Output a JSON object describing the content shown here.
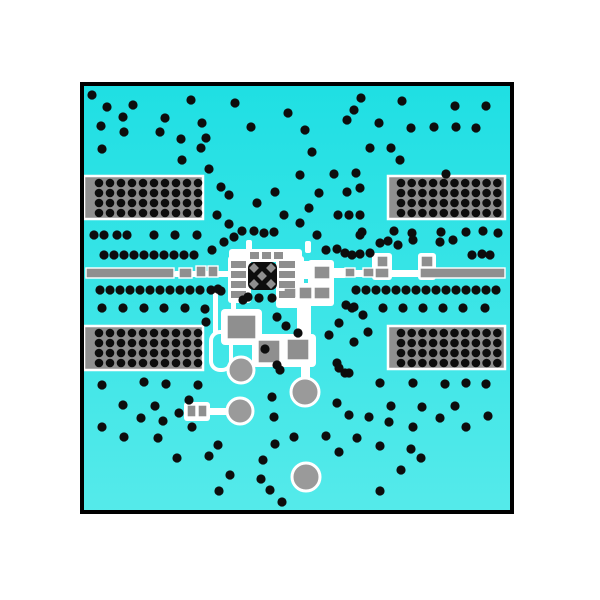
{
  "scene": {
    "width": 600,
    "height": 600,
    "background": "#ffffff",
    "description": "pcb-layer-view"
  },
  "board": {
    "x": 82,
    "y": 84,
    "w": 430,
    "h": 428,
    "border_color": "#000000",
    "border_width": 4,
    "fill_top": "#1fdfe3",
    "fill_bottom": "#55eaea"
  },
  "colors": {
    "pad_gray": "#8f8f8f",
    "circle_gray": "#9a9a9a",
    "via_black": "#0d0d0d",
    "mask_white": "#ffffff"
  },
  "via_radius": 4.6,
  "connector_blocks": [
    {
      "x": 84,
      "y": 176,
      "w": 119,
      "h": 43,
      "rows": 4,
      "cols": 10,
      "dot_x0": 99,
      "dot_y0": 183,
      "dx": 11,
      "dy": 10,
      "dot_r": 4.3
    },
    {
      "x": 388,
      "y": 176,
      "w": 117,
      "h": 43,
      "rows": 4,
      "cols": 10,
      "dot_x0": 401,
      "dot_y0": 183,
      "dx": 10.7,
      "dy": 10,
      "dot_r": 4.3
    },
    {
      "x": 84,
      "y": 326,
      "w": 119,
      "h": 44,
      "rows": 4,
      "cols": 10,
      "dot_x0": 99,
      "dot_y0": 333,
      "dx": 11,
      "dy": 10,
      "dot_r": 4.3
    },
    {
      "x": 388,
      "y": 326,
      "w": 117,
      "h": 43,
      "rows": 4,
      "cols": 10,
      "dot_x0": 401,
      "dot_y0": 333,
      "dx": 10.7,
      "dy": 10,
      "dot_r": 4.3
    }
  ],
  "white_shapes": [
    {
      "x": 229,
      "y": 249,
      "w": 73,
      "h": 13,
      "rx": 3
    },
    {
      "x": 228,
      "y": 256,
      "w": 23,
      "h": 47,
      "rx": 3
    },
    {
      "x": 276,
      "y": 256,
      "w": 28,
      "h": 52,
      "rx": 3
    },
    {
      "x": 246,
      "y": 240,
      "w": 6,
      "h": 12,
      "rx": 2
    },
    {
      "x": 305,
      "y": 241,
      "w": 6,
      "h": 12,
      "rx": 2
    },
    {
      "x": 174,
      "y": 271,
      "w": 58,
      "h": 6,
      "rx": 2
    },
    {
      "x": 293,
      "y": 261,
      "w": 22,
      "h": 18,
      "rx": 3
    },
    {
      "x": 308,
      "y": 260,
      "w": 26,
      "h": 46,
      "rx": 3
    },
    {
      "x": 332,
      "y": 268,
      "w": 14,
      "h": 10,
      "rx": 2
    },
    {
      "x": 338,
      "y": 270,
      "w": 84,
      "h": 7,
      "rx": 2
    },
    {
      "x": 372,
      "y": 253,
      "w": 20,
      "h": 27,
      "rx": 3
    },
    {
      "x": 418,
      "y": 253,
      "w": 18,
      "h": 27,
      "rx": 3
    },
    {
      "x": 280,
      "y": 283,
      "w": 37,
      "h": 22,
      "rx": 3
    },
    {
      "x": 297,
      "y": 298,
      "w": 14,
      "h": 42,
      "rx": 3
    },
    {
      "x": 221,
      "y": 309,
      "w": 41,
      "h": 36,
      "rx": 4
    },
    {
      "x": 252,
      "y": 334,
      "w": 64,
      "h": 33,
      "rx": 4
    },
    {
      "x": 301,
      "y": 357,
      "w": 9,
      "h": 24,
      "rx": 2
    },
    {
      "x": 213,
      "y": 290,
      "w": 5,
      "h": 44,
      "rx": 2
    },
    {
      "x": 231,
      "y": 300,
      "w": 5,
      "h": 12,
      "rx": 2
    },
    {
      "x": 184,
      "y": 402,
      "w": 26,
      "h": 19,
      "rx": 3
    },
    {
      "x": 208,
      "y": 408,
      "w": 22,
      "h": 7,
      "rx": 2
    }
  ],
  "trace_loop_outline": {
    "x": 211,
    "y": 332,
    "w": 20,
    "h": 38,
    "rx": 9,
    "stroke_width": 4
  },
  "gray_rects": [
    {
      "x": 86,
      "y": 268,
      "w": 88,
      "h": 10
    },
    {
      "x": 179,
      "y": 268,
      "w": 13,
      "h": 10
    },
    {
      "x": 196,
      "y": 266,
      "w": 10,
      "h": 11
    },
    {
      "x": 208,
      "y": 266,
      "w": 10,
      "h": 11
    },
    {
      "x": 345,
      "y": 268,
      "w": 10,
      "h": 9
    },
    {
      "x": 363,
      "y": 268,
      "w": 11,
      "h": 9
    },
    {
      "x": 375,
      "y": 268,
      "w": 14,
      "h": 10
    },
    {
      "x": 420,
      "y": 268,
      "w": 85,
      "h": 10
    },
    {
      "x": 377,
      "y": 256,
      "w": 11,
      "h": 11
    },
    {
      "x": 421,
      "y": 256,
      "w": 12,
      "h": 11
    },
    {
      "x": 314,
      "y": 266,
      "w": 16,
      "h": 13
    },
    {
      "x": 314,
      "y": 287,
      "w": 16,
      "h": 12
    },
    {
      "x": 284,
      "y": 288,
      "w": 12,
      "h": 10
    },
    {
      "x": 299,
      "y": 287,
      "w": 13,
      "h": 12
    },
    {
      "x": 227,
      "y": 315,
      "w": 29,
      "h": 24
    },
    {
      "x": 258,
      "y": 340,
      "w": 22,
      "h": 23
    },
    {
      "x": 287,
      "y": 339,
      "w": 22,
      "h": 21
    },
    {
      "x": 187,
      "y": 405,
      "w": 9,
      "h": 12
    },
    {
      "x": 198,
      "y": 405,
      "w": 9,
      "h": 12
    }
  ],
  "ic": {
    "body": {
      "x": 248,
      "y": 262,
      "w": 29,
      "h": 28,
      "rx": 6
    },
    "diamond_size": 7,
    "diamonds": [
      [
        262,
        276
      ],
      [
        254,
        268
      ],
      [
        271,
        268
      ],
      [
        254,
        284
      ],
      [
        271,
        284
      ]
    ],
    "left_pads": {
      "x": 231,
      "w": 15,
      "h": 7,
      "ys": [
        261,
        271,
        281,
        291
      ]
    },
    "right_pads": {
      "x": 279,
      "w": 16,
      "h": 7,
      "ys": [
        261,
        271,
        281,
        291
      ]
    },
    "top_pads": {
      "y": 252,
      "w": 9,
      "h": 7,
      "xs": [
        250,
        262,
        274
      ]
    }
  },
  "circles": [
    {
      "cx": 241,
      "cy": 370,
      "r": 13
    },
    {
      "cx": 305,
      "cy": 392,
      "r": 14
    },
    {
      "cx": 240,
      "cy": 411,
      "r": 13
    },
    {
      "cx": 306,
      "cy": 477,
      "r": 14
    }
  ],
  "vias": [
    [
      92,
      95
    ],
    [
      107,
      107
    ],
    [
      133,
      105
    ],
    [
      123,
      117
    ],
    [
      191,
      100
    ],
    [
      165,
      118
    ],
    [
      101,
      126
    ],
    [
      124,
      132
    ],
    [
      160,
      132
    ],
    [
      202,
      123
    ],
    [
      181,
      139
    ],
    [
      206,
      138
    ],
    [
      102,
      149
    ],
    [
      201,
      148
    ],
    [
      182,
      160
    ],
    [
      209,
      169
    ],
    [
      221,
      187
    ],
    [
      229,
      195
    ],
    [
      217,
      215
    ],
    [
      229,
      224
    ],
    [
      235,
      103
    ],
    [
      251,
      127
    ],
    [
      288,
      113
    ],
    [
      305,
      130
    ],
    [
      361,
      98
    ],
    [
      354,
      110
    ],
    [
      347,
      120
    ],
    [
      379,
      123
    ],
    [
      312,
      152
    ],
    [
      370,
      148
    ],
    [
      300,
      175
    ],
    [
      334,
      174
    ],
    [
      356,
      173
    ],
    [
      275,
      192
    ],
    [
      319,
      193
    ],
    [
      347,
      192
    ],
    [
      360,
      188
    ],
    [
      257,
      203
    ],
    [
      309,
      208
    ],
    [
      284,
      215
    ],
    [
      338,
      215
    ],
    [
      349,
      215
    ],
    [
      360,
      215
    ],
    [
      300,
      223
    ],
    [
      242,
      231
    ],
    [
      254,
      231
    ],
    [
      264,
      233
    ],
    [
      274,
      232
    ],
    [
      317,
      235
    ],
    [
      362,
      232
    ],
    [
      402,
      101
    ],
    [
      455,
      106
    ],
    [
      486,
      106
    ],
    [
      411,
      128
    ],
    [
      434,
      127
    ],
    [
      456,
      127
    ],
    [
      476,
      128
    ],
    [
      391,
      148
    ],
    [
      400,
      160
    ],
    [
      446,
      174
    ],
    [
      394,
      231
    ],
    [
      412,
      233
    ],
    [
      441,
      232
    ],
    [
      466,
      232
    ],
    [
      483,
      231
    ],
    [
      498,
      233
    ],
    [
      360,
      235
    ],
    [
      380,
      243
    ],
    [
      388,
      241
    ],
    [
      398,
      245
    ],
    [
      413,
      240
    ],
    [
      440,
      242
    ],
    [
      453,
      240
    ],
    [
      345,
      253
    ],
    [
      352,
      255
    ],
    [
      370,
      253
    ],
    [
      472,
      255
    ],
    [
      482,
      254
    ],
    [
      490,
      255
    ],
    [
      326,
      250
    ],
    [
      337,
      249
    ],
    [
      360,
      254
    ],
    [
      94,
      235
    ],
    [
      104,
      235
    ],
    [
      117,
      235
    ],
    [
      127,
      235
    ],
    [
      154,
      235
    ],
    [
      175,
      235
    ],
    [
      197,
      235
    ],
    [
      234,
      237
    ],
    [
      224,
      242
    ],
    [
      212,
      250
    ],
    [
      104,
      255
    ],
    [
      114,
      255
    ],
    [
      124,
      255
    ],
    [
      134,
      255
    ],
    [
      144,
      255
    ],
    [
      154,
      255
    ],
    [
      164,
      255
    ],
    [
      174,
      255
    ],
    [
      184,
      255
    ],
    [
      194,
      255
    ],
    [
      100,
      290
    ],
    [
      110,
      290
    ],
    [
      120,
      290
    ],
    [
      130,
      290
    ],
    [
      140,
      290
    ],
    [
      150,
      290
    ],
    [
      160,
      290
    ],
    [
      170,
      290
    ],
    [
      180,
      290
    ],
    [
      190,
      290
    ],
    [
      200,
      290
    ],
    [
      211,
      290
    ],
    [
      221,
      291
    ],
    [
      102,
      308
    ],
    [
      123,
      308
    ],
    [
      144,
      308
    ],
    [
      164,
      308
    ],
    [
      185,
      308
    ],
    [
      205,
      309
    ],
    [
      356,
      290
    ],
    [
      366,
      290
    ],
    [
      376,
      290
    ],
    [
      386,
      290
    ],
    [
      396,
      290
    ],
    [
      406,
      290
    ],
    [
      416,
      290
    ],
    [
      426,
      290
    ],
    [
      436,
      290
    ],
    [
      446,
      290
    ],
    [
      456,
      290
    ],
    [
      466,
      290
    ],
    [
      476,
      290
    ],
    [
      486,
      290
    ],
    [
      496,
      290
    ],
    [
      352,
      308
    ],
    [
      383,
      308
    ],
    [
      403,
      308
    ],
    [
      423,
      308
    ],
    [
      443,
      308
    ],
    [
      463,
      308
    ],
    [
      485,
      308
    ],
    [
      218,
      289
    ],
    [
      243,
      300
    ],
    [
      248,
      297
    ],
    [
      259,
      298
    ],
    [
      272,
      298
    ],
    [
      277,
      317
    ],
    [
      286,
      326
    ],
    [
      298,
      333
    ],
    [
      265,
      349
    ],
    [
      277,
      365
    ],
    [
      329,
      335
    ],
    [
      337,
      363
    ],
    [
      345,
      373
    ],
    [
      346,
      305
    ],
    [
      354,
      307
    ],
    [
      363,
      315
    ],
    [
      339,
      323
    ],
    [
      368,
      332
    ],
    [
      354,
      342
    ],
    [
      206,
      322
    ],
    [
      280,
      370
    ],
    [
      339,
      368
    ],
    [
      349,
      373
    ],
    [
      380,
      383
    ],
    [
      272,
      397
    ],
    [
      337,
      403
    ],
    [
      349,
      415
    ],
    [
      369,
      417
    ],
    [
      274,
      417
    ],
    [
      294,
      437
    ],
    [
      326,
      436
    ],
    [
      275,
      444
    ],
    [
      357,
      438
    ],
    [
      339,
      452
    ],
    [
      380,
      446
    ],
    [
      263,
      460
    ],
    [
      261,
      479
    ],
    [
      270,
      490
    ],
    [
      282,
      502
    ],
    [
      380,
      491
    ],
    [
      102,
      385
    ],
    [
      144,
      382
    ],
    [
      166,
      384
    ],
    [
      198,
      385
    ],
    [
      123,
      405
    ],
    [
      155,
      406
    ],
    [
      189,
      400
    ],
    [
      179,
      413
    ],
    [
      141,
      418
    ],
    [
      102,
      427
    ],
    [
      163,
      421
    ],
    [
      124,
      437
    ],
    [
      158,
      438
    ],
    [
      192,
      427
    ],
    [
      218,
      445
    ],
    [
      177,
      458
    ],
    [
      209,
      456
    ],
    [
      230,
      475
    ],
    [
      219,
      491
    ],
    [
      413,
      383
    ],
    [
      445,
      384
    ],
    [
      466,
      383
    ],
    [
      486,
      384
    ],
    [
      391,
      406
    ],
    [
      422,
      407
    ],
    [
      455,
      406
    ],
    [
      440,
      418
    ],
    [
      488,
      416
    ],
    [
      389,
      422
    ],
    [
      413,
      427
    ],
    [
      466,
      427
    ],
    [
      411,
      449
    ],
    [
      421,
      458
    ],
    [
      401,
      470
    ]
  ]
}
